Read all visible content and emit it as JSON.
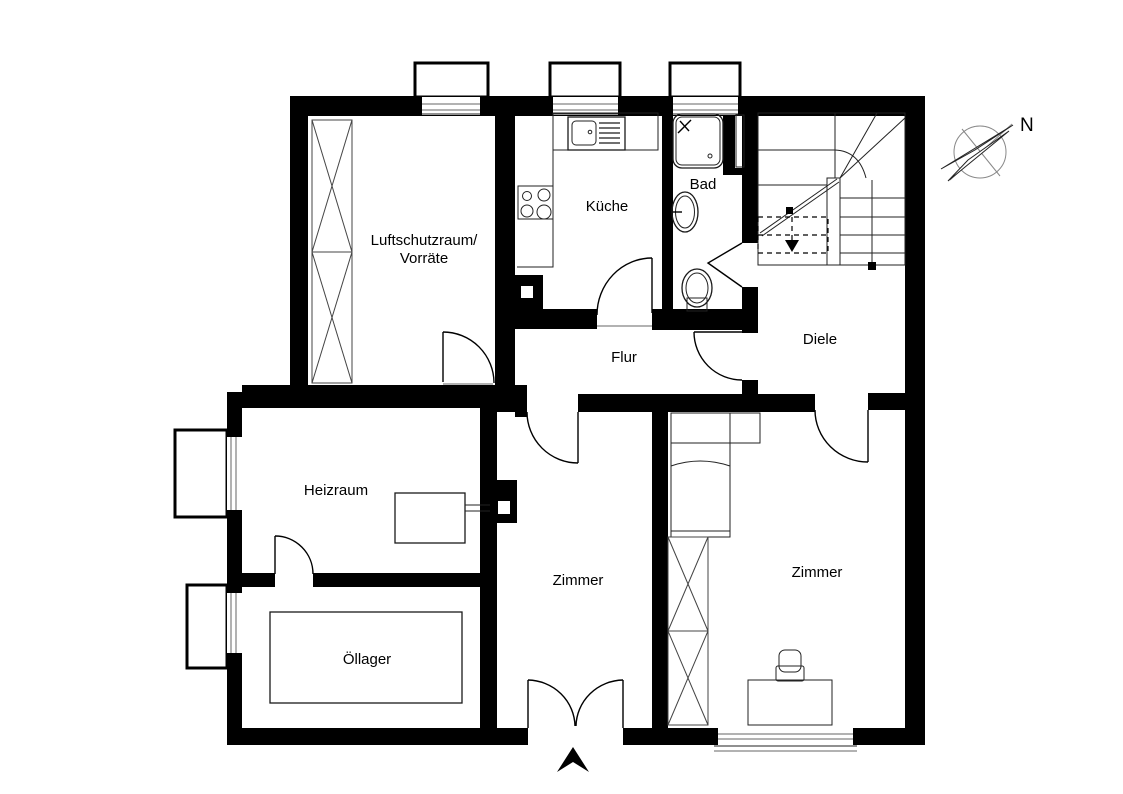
{
  "title": "Grundriss Kellergeschoss",
  "rooms": {
    "luftschutzraum": {
      "line1": "Luftschutzraum/",
      "line2": "Vorräte"
    },
    "kueche": {
      "label": "Küche"
    },
    "bad": {
      "label": "Bad"
    },
    "flur": {
      "label": "Flur"
    },
    "diele": {
      "label": "Diele"
    },
    "heizraum": {
      "label": "Heizraum"
    },
    "zimmer_left": {
      "label": "Zimmer"
    },
    "zimmer_right": {
      "label": "Zimmer"
    },
    "oellager": {
      "label": "Öllager"
    }
  },
  "compass": {
    "label": "N"
  },
  "watermark": "McGrundriss",
  "colors": {
    "walls": "#000000",
    "background": "#ffffff",
    "thin_lines": "#1a1a1a",
    "threshold_gray": "#999999",
    "compass_needle_fill": "#c4c4c4",
    "watermark_text": "#bbbbbb"
  }
}
